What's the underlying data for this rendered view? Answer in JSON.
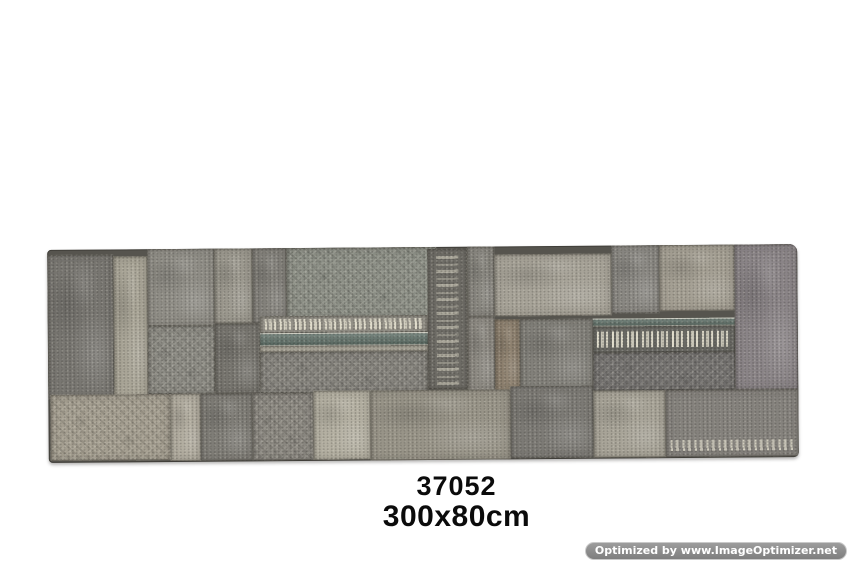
{
  "page": {
    "background": "#ffffff"
  },
  "product": {
    "code": "37052",
    "size": "300x80cm"
  },
  "watermark": {
    "text": "Optimized by www.ImageOptimizer.net"
  },
  "rug": {
    "description": "grey vintage patchwork carpet runner, top-down product photo",
    "seam_color": "#56544e",
    "tilt_deg": -0.45,
    "position": {
      "left": 48,
      "top": 247,
      "width": 750,
      "height": 213
    },
    "accent_teal": "#5f7068",
    "motif_cream": "#e4e0cf",
    "patches": [
      {
        "x": 0,
        "y": 5,
        "w": 66,
        "h": 145,
        "c": "#787671",
        "v": "mottled"
      },
      {
        "x": 66,
        "y": 7,
        "w": 34,
        "h": 143,
        "c": "#a9a597",
        "v": "mottled"
      },
      {
        "x": 100,
        "y": 0,
        "w": 67,
        "h": 77,
        "c": "#8f8d86",
        "v": "mottled"
      },
      {
        "x": 167,
        "y": 0,
        "w": 38,
        "h": 75,
        "c": "#9c998f",
        "v": "mottled"
      },
      {
        "x": 205,
        "y": 0,
        "w": 34,
        "h": 75,
        "c": "#83817b",
        "v": "mottled"
      },
      {
        "x": 239,
        "y": 0,
        "w": 150,
        "h": 72,
        "c": "#8c8f86",
        "v": "ornate"
      },
      {
        "x": 380,
        "y": 2,
        "w": 40,
        "h": 140,
        "c": "#6e6c66",
        "v": "vertical-motifs"
      },
      {
        "x": 420,
        "y": 0,
        "w": 27,
        "h": 70,
        "c": "#898780",
        "v": "mottled"
      },
      {
        "x": 447,
        "y": 8,
        "w": 117,
        "h": 62,
        "c": "#a7a398",
        "v": "mottled"
      },
      {
        "x": 564,
        "y": 0,
        "w": 48,
        "h": 68,
        "c": "#8a8883",
        "v": "mottled"
      },
      {
        "x": 612,
        "y": 0,
        "w": 75,
        "h": 66,
        "c": "#a49f93",
        "v": "mottled"
      },
      {
        "x": 687,
        "y": 0,
        "w": 63,
        "h": 145,
        "c": "#8a8487",
        "v": "mottled"
      },
      {
        "x": 100,
        "y": 77,
        "w": 67,
        "h": 68,
        "c": "#8b8a83",
        "v": "ornate"
      },
      {
        "x": 167,
        "y": 75,
        "w": 45,
        "h": 70,
        "c": "#77756f",
        "v": "mottled"
      },
      {
        "x": 212,
        "y": 68,
        "w": 168,
        "h": 17,
        "c": "#96938a",
        "v": "motif-row"
      },
      {
        "x": 212,
        "y": 85,
        "w": 168,
        "h": 13,
        "c": "#5f7068",
        "v": "teal-band"
      },
      {
        "x": 212,
        "y": 98,
        "w": 168,
        "h": 6,
        "c": "#b6b2a5",
        "v": "plain"
      },
      {
        "x": 212,
        "y": 104,
        "w": 168,
        "h": 41,
        "c": "#85837d",
        "v": "ornate"
      },
      {
        "x": 420,
        "y": 70,
        "w": 27,
        "h": 75,
        "c": "#8e8b84",
        "v": "mottled"
      },
      {
        "x": 447,
        "y": 73,
        "w": 25,
        "h": 72,
        "c": "#8f8270",
        "v": "mottled"
      },
      {
        "x": 472,
        "y": 73,
        "w": 73,
        "h": 72,
        "c": "#82807a",
        "v": "mottled"
      },
      {
        "x": 545,
        "y": 73,
        "w": 142,
        "h": 8,
        "c": "#5d6e66",
        "v": "teal-band"
      },
      {
        "x": 545,
        "y": 81,
        "w": 142,
        "h": 26,
        "c": "#6b6b66",
        "v": "motif-row"
      },
      {
        "x": 545,
        "y": 107,
        "w": 142,
        "h": 38,
        "c": "#747270",
        "v": "ornate"
      },
      {
        "x": 2,
        "y": 145,
        "w": 120,
        "h": 66,
        "c": "#a49e90",
        "v": "ornate"
      },
      {
        "x": 122,
        "y": 145,
        "w": 30,
        "h": 67,
        "c": "#b2ada0",
        "v": "mottled"
      },
      {
        "x": 152,
        "y": 145,
        "w": 52,
        "h": 67,
        "c": "#7f7d77",
        "v": "mottled"
      },
      {
        "x": 204,
        "y": 145,
        "w": 61,
        "h": 67,
        "c": "#8a8780",
        "v": "ornate"
      },
      {
        "x": 265,
        "y": 143,
        "w": 57,
        "h": 69,
        "c": "#b4b0a2",
        "v": "mottled"
      },
      {
        "x": 322,
        "y": 143,
        "w": 140,
        "h": 70,
        "c": "#989488",
        "v": "mottled"
      },
      {
        "x": 462,
        "y": 140,
        "w": 83,
        "h": 72,
        "c": "#7c7a75",
        "v": "mottled"
      },
      {
        "x": 545,
        "y": 145,
        "w": 72,
        "h": 67,
        "c": "#a8a498",
        "v": "mottled"
      },
      {
        "x": 617,
        "y": 145,
        "w": 133,
        "h": 67,
        "c": "#85827d",
        "v": "bottom-motifs"
      }
    ]
  }
}
